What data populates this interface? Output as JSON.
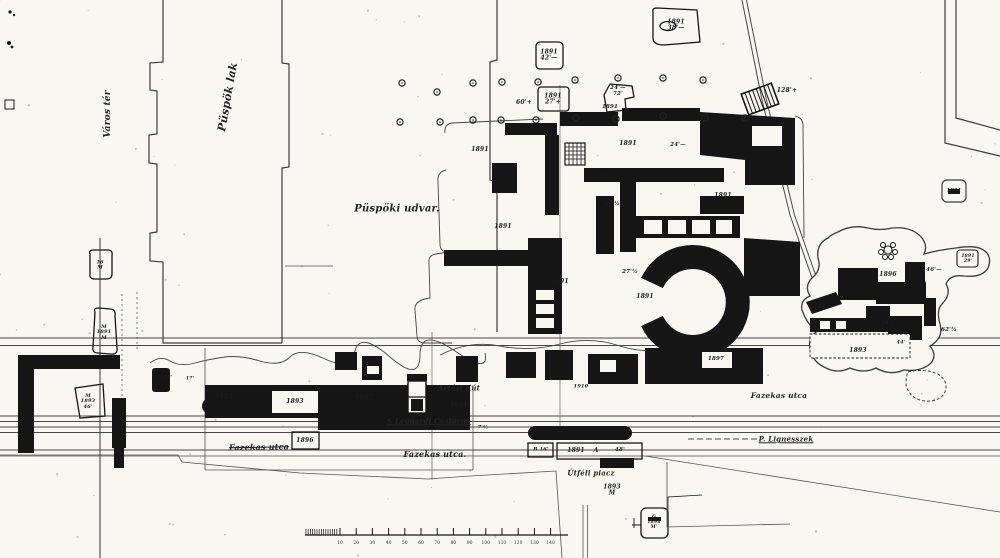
{
  "map": {
    "type": "scanned archaeological excavation site plan",
    "ink_color": "#161616",
    "paper_color": "#f8f7f2",
    "areas": {
      "varos_ter": "Város tér",
      "puspok_lak": "Püspök lak",
      "puspoki_udvar": "Püspöki udvar.",
      "artezi_kut": "Artézi Kút",
      "csatorna": "S Leonardi Csatorna",
      "fazekas_utca": "Fazekas utca",
      "lignesszek": "P.  Lignesszek",
      "utfeli_piacz": "Útféli piacz"
    },
    "labels": [
      {
        "name": "label-varos-ter",
        "text": "Város tér",
        "x": 109,
        "y": 114,
        "rot": -90,
        "fs": 9,
        "cls": "area"
      },
      {
        "name": "label-puspok-lak",
        "text": "Püspök lak",
        "x": 228,
        "y": 97,
        "rot": -80,
        "fs": 11,
        "cls": "area"
      },
      {
        "name": "label-puspoki-udvar",
        "text": "Püspöki udvar.",
        "x": 397,
        "y": 210,
        "rot": 0,
        "fs": 10,
        "cls": "area"
      },
      {
        "name": "label-artezi-kut",
        "text": "Artézi Kút",
        "x": 459,
        "y": 388,
        "rot": 0,
        "fs": 7,
        "cls": "area"
      },
      {
        "name": "label-csatorna",
        "text": "S Leonardi Csatorna",
        "x": 429,
        "y": 421,
        "rot": 0,
        "fs": 7,
        "cls": "area underline"
      },
      {
        "name": "label-fazekas-utca-1",
        "text": "Fazekas utca",
        "x": 259,
        "y": 447,
        "rot": -1,
        "fs": 8,
        "cls": "area strike"
      },
      {
        "name": "label-fazekas-utca-2",
        "text": "Fazekas utca.",
        "x": 435,
        "y": 454,
        "rot": 0,
        "fs": 8,
        "cls": "area"
      },
      {
        "name": "label-fazekas-utca-3",
        "text": "Fazekas utca",
        "x": 779,
        "y": 396,
        "rot": 0,
        "fs": 7.5,
        "cls": "area"
      },
      {
        "name": "label-lignesszek",
        "text": "P.  Lignesszek",
        "x": 786,
        "y": 439,
        "rot": 0,
        "fs": 7,
        "cls": "area underline"
      },
      {
        "name": "label-utfeli-piacz",
        "text": "Útféli piacz",
        "x": 591,
        "y": 473,
        "rot": 0,
        "fs": 7,
        "cls": "area"
      },
      {
        "name": "year-label",
        "text": "1891\n42'—",
        "x": 549,
        "y": 56,
        "fs": 6
      },
      {
        "name": "year-label",
        "text": "1891\n27'+",
        "x": 553,
        "y": 100,
        "fs": 6
      },
      {
        "name": "measure-label",
        "text": "24'—\n72'",
        "x": 618,
        "y": 92,
        "fs": 5.5
      },
      {
        "name": "year-label",
        "text": "1891",
        "x": 610,
        "y": 108,
        "fs": 5.5
      },
      {
        "name": "year-label",
        "text": "1891\n38'—",
        "x": 676,
        "y": 26,
        "fs": 6
      },
      {
        "name": "measure-label",
        "text": "60'+",
        "x": 524,
        "y": 103,
        "fs": 6
      },
      {
        "name": "measure-label",
        "text": "128'+",
        "x": 787,
        "y": 91,
        "fs": 6
      },
      {
        "name": "year-label",
        "text": "1891",
        "x": 954,
        "y": 191,
        "fs": 5
      },
      {
        "name": "year-label",
        "text": "1891",
        "x": 480,
        "y": 150,
        "fs": 6
      },
      {
        "name": "year-label",
        "text": "1891",
        "x": 628,
        "y": 144,
        "fs": 6
      },
      {
        "name": "measure-label",
        "text": "24'—",
        "x": 678,
        "y": 146,
        "fs": 5.5
      },
      {
        "name": "year-label",
        "text": "1891",
        "x": 503,
        "y": 227,
        "fs": 6
      },
      {
        "name": "measure-label",
        "text": "22'½",
        "x": 612,
        "y": 205,
        "fs": 5.5
      },
      {
        "name": "measure-label",
        "text": "8'+",
        "x": 604,
        "y": 176,
        "fs": 5
      },
      {
        "name": "year-label",
        "text": "1891",
        "x": 723,
        "y": 196,
        "fs": 6
      },
      {
        "name": "year-label",
        "text": "1891",
        "x": 560,
        "y": 282,
        "fs": 6
      },
      {
        "name": "measure-label",
        "text": "27'½",
        "x": 630,
        "y": 273,
        "fs": 5.5
      },
      {
        "name": "year-label",
        "text": "1891",
        "x": 645,
        "y": 297,
        "fs": 6
      },
      {
        "name": "year-label",
        "text": "1897",
        "x": 716,
        "y": 360,
        "fs": 5.5
      },
      {
        "name": "year-label",
        "text": "1896",
        "x": 888,
        "y": 275,
        "fs": 6
      },
      {
        "name": "measure-label",
        "text": "46'—",
        "x": 934,
        "y": 271,
        "fs": 5.5
      },
      {
        "name": "measure-label",
        "text": "29'+",
        "x": 888,
        "y": 325,
        "fs": 5.5
      },
      {
        "name": "year-label",
        "text": "1893",
        "x": 858,
        "y": 351,
        "fs": 6
      },
      {
        "name": "measure-label",
        "text": "62'½",
        "x": 949,
        "y": 331,
        "fs": 5.5
      },
      {
        "name": "measure-label",
        "text": "44'",
        "x": 901,
        "y": 343,
        "fs": 5
      },
      {
        "name": "year-label",
        "text": "1891\n29'",
        "x": 968,
        "y": 260,
        "fs": 4.5
      },
      {
        "name": "marker-label",
        "text": "16\nM",
        "x": 100,
        "y": 266,
        "fs": 5
      },
      {
        "name": "marker-label",
        "text": "M\n1891\nM",
        "x": 104,
        "y": 333,
        "fs": 5
      },
      {
        "name": "marker-label",
        "text": "M\n1893\n46'",
        "x": 88,
        "y": 402,
        "fs": 5
      },
      {
        "name": "year-label",
        "text": "1892",
        "x": 224,
        "y": 397,
        "fs": 6
      },
      {
        "name": "year-label",
        "text": "1893",
        "x": 295,
        "y": 402,
        "fs": 6
      },
      {
        "name": "year-label",
        "text": "1896",
        "x": 305,
        "y": 441,
        "fs": 6
      },
      {
        "name": "year-label",
        "text": "1897",
        "x": 364,
        "y": 398,
        "fs": 6
      },
      {
        "name": "year-label",
        "text": "1895",
        "x": 459,
        "y": 406,
        "fs": 6
      },
      {
        "name": "year-label",
        "text": "1910",
        "x": 581,
        "y": 387,
        "fs": 5
      },
      {
        "name": "marker-label",
        "text": "B 16'",
        "x": 541,
        "y": 450,
        "fs": 5
      },
      {
        "name": "year-label",
        "text": "1891",
        "x": 576,
        "y": 451,
        "fs": 6
      },
      {
        "name": "marker-label",
        "text": "A",
        "x": 596,
        "y": 451,
        "fs": 6
      },
      {
        "name": "measure-label",
        "text": "48'",
        "x": 620,
        "y": 451,
        "fs": 5.5
      },
      {
        "name": "year-label",
        "text": "1893\nM",
        "x": 612,
        "y": 491,
        "fs": 6
      },
      {
        "name": "marker-label",
        "text": "G\n1898\nM'",
        "x": 654,
        "y": 523,
        "fs": 4.5
      },
      {
        "name": "measure-label",
        "text": "7'½",
        "x": 483,
        "y": 428,
        "fs": 5
      },
      {
        "name": "measure-label",
        "text": "34'",
        "x": 28,
        "y": 451,
        "fs": 5
      },
      {
        "name": "measure-label",
        "text": "16'",
        "x": 168,
        "y": 379,
        "fs": 4.5
      },
      {
        "name": "measure-label",
        "text": "17'",
        "x": 190,
        "y": 380,
        "fs": 4.5
      }
    ],
    "trees": [
      [
        402,
        83
      ],
      [
        437,
        92
      ],
      [
        473,
        83
      ],
      [
        502,
        82
      ],
      [
        538,
        82
      ],
      [
        575,
        80
      ],
      [
        618,
        78
      ],
      [
        663,
        78
      ],
      [
        703,
        80
      ],
      [
        400,
        122
      ],
      [
        440,
        122
      ],
      [
        473,
        120
      ],
      [
        501,
        120
      ],
      [
        536,
        120
      ],
      [
        576,
        118
      ],
      [
        616,
        119
      ],
      [
        663,
        116
      ],
      [
        705,
        118
      ],
      [
        745,
        118
      ]
    ],
    "scalebar": {
      "y": 535,
      "line_start": 305,
      "line_end": 568,
      "comb_start": 306,
      "comb_end": 337,
      "tick_start": 340,
      "tick_step": 16.2,
      "ticks": [
        "10",
        "20",
        "30",
        "40",
        "50",
        "60",
        "70",
        "80",
        "90",
        "100",
        "110",
        "120",
        "130",
        "140"
      ]
    }
  }
}
